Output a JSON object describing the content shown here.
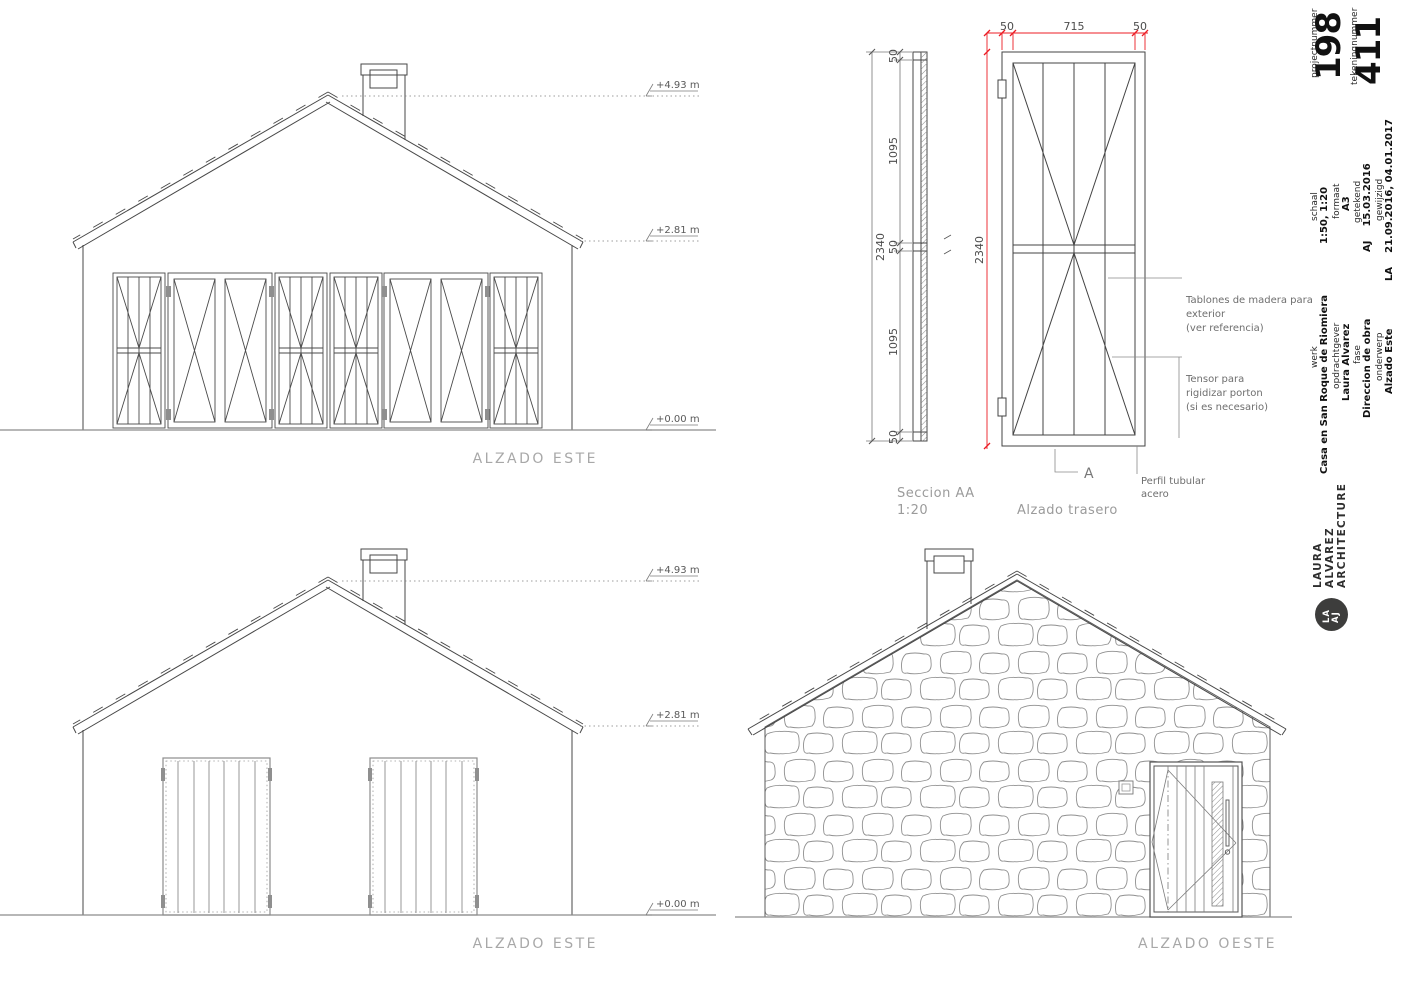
{
  "views": {
    "alzado_este_top": {
      "label": "ALZADO ESTE"
    },
    "alzado_este_bottom": {
      "label": "ALZADO ESTE"
    },
    "alzado_oeste": {
      "label": "ALZADO OESTE"
    },
    "seccion": {
      "title": "Seccion AA",
      "scale": "1:20"
    },
    "alzado_trasero": {
      "label": "Alzado trasero"
    }
  },
  "levels": {
    "ridge": "+4.93 m",
    "eave": "+2.81 m",
    "ground": "+0.00 m"
  },
  "dims": {
    "door_top": [
      "50",
      "715",
      "50"
    ],
    "door_height": "2340",
    "section_chain": [
      "50",
      "1095",
      "50",
      "1095",
      "50"
    ],
    "section_total": "2340"
  },
  "annotations": {
    "tablones_l1": "Tablones de madera para",
    "tablones_l2": "exterior",
    "tablones_l3": "(ver referencia)",
    "tensor_l1": "Tensor para",
    "tensor_l2": "rigidizar porton",
    "tensor_l3": "(si es necesario)",
    "perfil_l1": "Perfil tubular",
    "perfil_l2": "acero",
    "section_marker": "A"
  },
  "titleblock": {
    "projectnummer_label": "projectnummer",
    "projectnummer": "198",
    "tekeningnummer_label": "tekeningnummer",
    "tekeningnummer": "411",
    "schaal_label": "schaal",
    "schaal": "1:50, 1:20",
    "formaat_label": "formaat",
    "formaat": "A3",
    "getekend_label": "getekend",
    "getekend_initials": "AJ",
    "getekend_date": "15.03.2016",
    "gewijzigd_label": "gewijzigd",
    "gewijzigd_initials": "LA",
    "gewijzigd_dates": "21.09.2016, 04.01.2017",
    "werk_label": "werk",
    "werk": "Casa en San Roque de Riomiera",
    "opdrachtgever_label": "opdrachtgever",
    "opdrachtgever": "Laura Alvarez",
    "fase_label": "fase",
    "fase": "Direccion de obra",
    "onderwerp_label": "onderwerp",
    "onderwerp": "Alzado Este",
    "firm": {
      "line1": "LAURA",
      "line2": "ALVAREZ",
      "line3": "ARCHITECTURE",
      "monogram_top": "LA",
      "monogram_bottom": "AJ"
    }
  },
  "colors": {
    "dimension_red": "#ec1c24",
    "line_dark": "#434343",
    "line_gray": "#8c8c8c",
    "label_gray": "#a8a8a8"
  }
}
